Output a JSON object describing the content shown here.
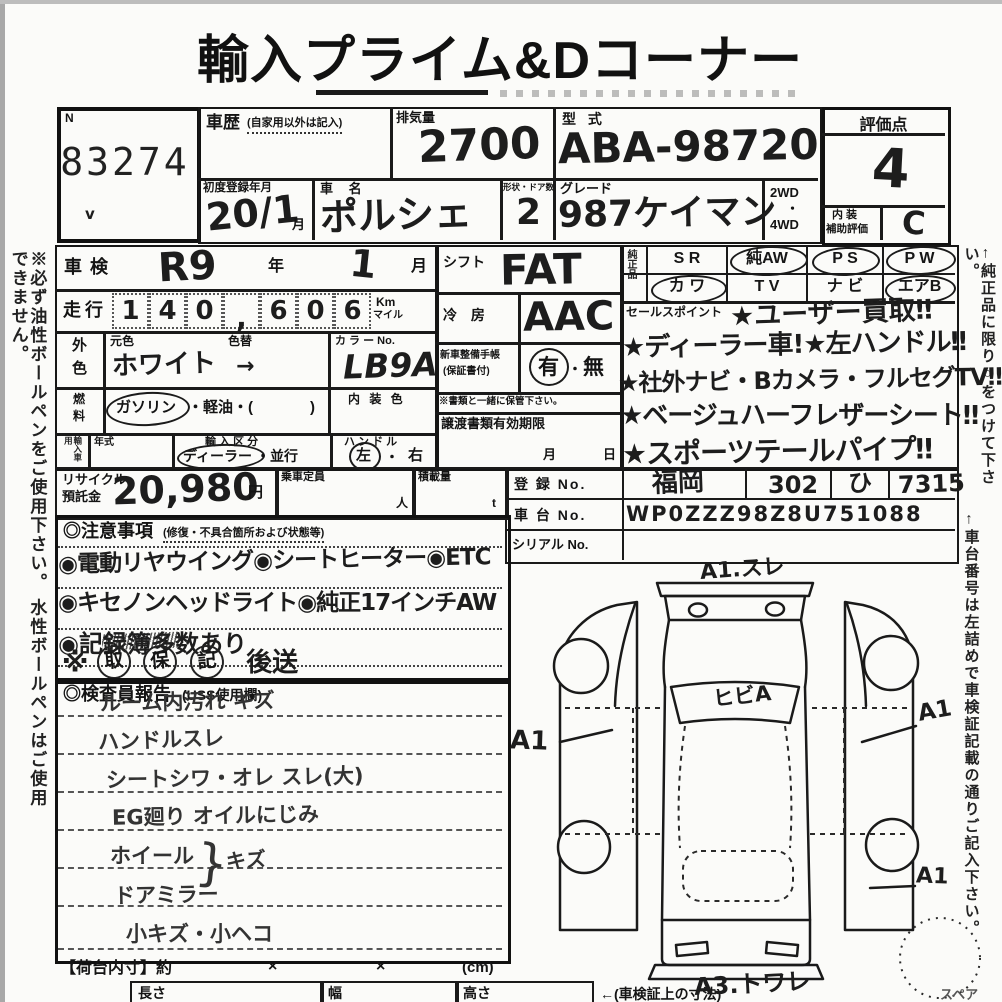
{
  "title": "輸入プライム&Dコーナー",
  "margin_notes": {
    "left": "※必ず油性ボールペンをご使用下さい。 水性ボールペンはご使用できません。",
    "right_oem": "←純正品に限り○をつけて下さい。",
    "right_chassis": "←車台番号は左詰めで車検証記載の通りご記入下さい。"
  },
  "lot": {
    "label": "N",
    "number": "83274",
    "check": "v"
  },
  "header": {
    "history_label": "車歴",
    "history_note": "(自家用以外は記入)",
    "displacement_label": "排気量",
    "displacement": "2700",
    "model_label": "型 式",
    "model": "ABA-98720",
    "first_reg_label": "初度登録年月",
    "first_reg": "20/1",
    "first_reg_unit": "月",
    "name_label": "車 名",
    "name": "ポルシェ",
    "doors_label": "形状・ドア数",
    "doors": "2",
    "grade_label": "グレード",
    "grade": "987ケイマン",
    "drive1": "2WD",
    "drive_dot": "・",
    "drive2": "4WD"
  },
  "score": {
    "label": "評価点",
    "value": "4",
    "interior_label1": "内 装",
    "interior_label2": "補助評価",
    "interior": "C"
  },
  "inspection": {
    "label": "車検",
    "era": "R9",
    "year_unit": "年",
    "month": "1",
    "month_unit": "月"
  },
  "mileage": {
    "label": "走行",
    "digits": [
      "1",
      "4",
      "0",
      ",",
      "6",
      "0",
      "6"
    ],
    "unit1": "Km",
    "unit2": "マイル"
  },
  "color": {
    "label1": "外",
    "label2": "色",
    "orig_label": "元色",
    "orig": "ホワイト",
    "change_label": "色替",
    "change": "→",
    "no_label": "カ ラ ー No.",
    "no": "LB9A"
  },
  "fuel": {
    "label1": "燃",
    "label2": "料",
    "gas": "ガソリン",
    "rest": "・軽油・(",
    "close": ")",
    "interior_label": "内 装 色"
  },
  "import": {
    "label": "輸入車用",
    "year_label": "年式",
    "class_label": "輸 入 区 分",
    "dealer": "ディーラー",
    "parallel": "・並行",
    "handle_label": "ハ ン ド ル",
    "left": "左",
    "dot": "・",
    "right": "右"
  },
  "equip": {
    "shift_label": "シフト",
    "shift": "FAT",
    "ac_label": "冷 房",
    "ac": "AAC",
    "manual_label1": "新車整備手帳",
    "manual_label2": "(保証書付)",
    "yes": "有",
    "dot": "・",
    "no": "無",
    "keep_note": "※書類と一緒に保管下さい。",
    "transfer_label": "譲渡書類有効期限",
    "transfer_month": "月",
    "transfer_day": "日"
  },
  "oem": {
    "label": "純正品",
    "r1c1": "S R",
    "r1c2": "純AW",
    "r1c3": "P S",
    "r1c4": "P W",
    "r2c1": "カ ワ",
    "r2c2": "T V",
    "r2c3": "ナ ビ",
    "r2c4": "エアB"
  },
  "sales": {
    "label": "セールスポイント",
    "l1": "★ユーザー買取‼",
    "l2": "★ディーラー車!★左ハンドル‼",
    "l3": "★社外ナビ・Bカメラ・フルセグTV‼",
    "l4": "★ベージュハーフレザーシート‼",
    "l5": "★スポーツテールパイプ‼"
  },
  "recycle": {
    "label1": "リサイクル",
    "label2": "預託金",
    "value": "20,980",
    "unit": "円",
    "pax_label": "乗車定員",
    "pax_unit": "人",
    "load_label": "積載量",
    "load_unit": "t"
  },
  "registration": {
    "reg_label": "登 録 No.",
    "reg1": "福岡",
    "reg2": "302",
    "reg3": "ひ",
    "reg4": "7315",
    "chassis_label": "車 台 No.",
    "chassis": "WP0ZZZ98Z8U751088",
    "serial_label": "シリアル No."
  },
  "cautions": {
    "title": "◎注意事項",
    "subtitle": "(修復・不具合箇所および状態等)",
    "l1": "◉電動リヤウイング◉シートヒーター◉ETC",
    "l2": "◉キセノンヘッドライト◉純正17インチAW",
    "l3": "◉記録簿多数あり",
    "l4_prefix": "※",
    "c1": "取",
    "c2": "保",
    "c3": "記",
    "l4_suffix": "後送"
  },
  "inspector": {
    "title": "◎検査員報告",
    "subtitle": "(USS使用欄)",
    "l1": "ルーム内汚れ キズ",
    "l2": "ハンドルスレ",
    "l3": "シートシワ・オレ スレ(大)",
    "l4": "EG廻り オイルにじみ",
    "l5": "ホイール",
    "brace": "}",
    "l5b": "キズ",
    "l6": "ドアミラー",
    "l7": "小キズ・小ヘコ"
  },
  "cargo": {
    "label": "【荷台内寸】約",
    "x1": "×",
    "x2": "×",
    "unit": "(cm)",
    "col1": "長さ",
    "col2": "幅",
    "col3": "高さ",
    "note": "←(車検証上の寸法)"
  },
  "diagram": {
    "top": "A1.スレ",
    "windshield": "ヒビA",
    "left": "A1",
    "right1": "A1",
    "right2": "A1",
    "bottom": "A3.トワレ",
    "spare": "スペア"
  }
}
